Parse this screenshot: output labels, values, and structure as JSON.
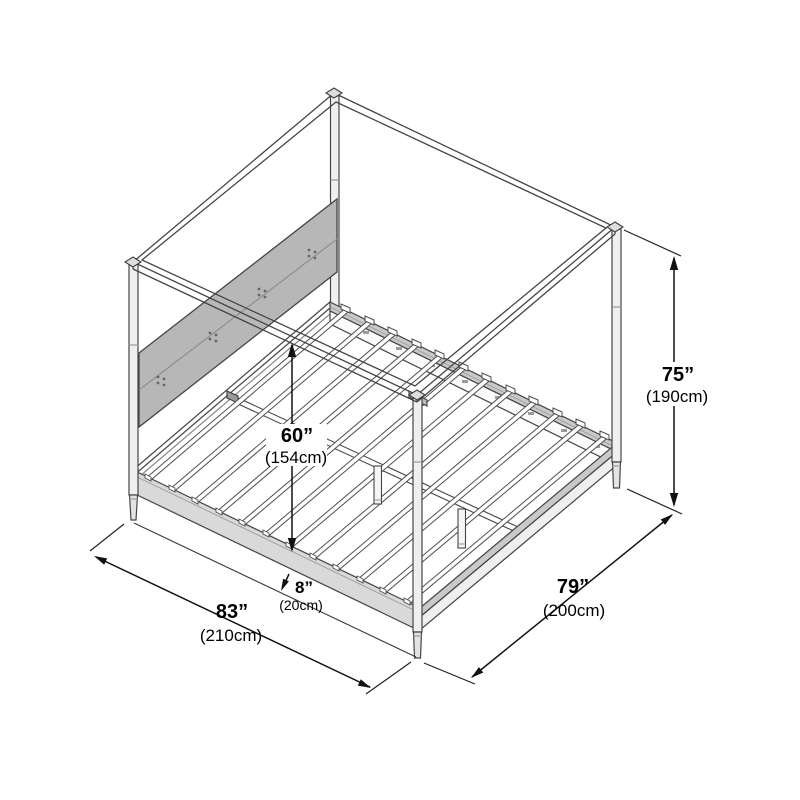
{
  "diagram": {
    "type": "product-dimension-diagram",
    "subject": "four-poster canopy bed frame with headboard and slat base, isometric line drawing",
    "units": [
      "inches",
      "centimeters"
    ],
    "dimensions": {
      "height": {
        "label": "overall height",
        "inches": "75”",
        "cm": "(190cm)"
      },
      "interior_clearance": {
        "label": "interior clearance",
        "inches": "60”",
        "cm": "(154cm)"
      },
      "under_bed": {
        "label": "under-bed clearance",
        "inches": "8”",
        "cm": "(20cm)"
      },
      "length": {
        "label": "overall length",
        "inches": "83”",
        "cm": "(210cm)"
      },
      "width": {
        "label": "overall width",
        "inches": "79”",
        "cm": "(200cm)"
      }
    },
    "colors": {
      "background": "#ffffff",
      "line_work": "#454545",
      "dimension_line": "#111111",
      "headboard_fill": "#b7b7b7",
      "rail_top_fill": "#c9c9c9",
      "side_rail_fill": "#d9d9d9",
      "post_fill": "#efefef"
    }
  }
}
